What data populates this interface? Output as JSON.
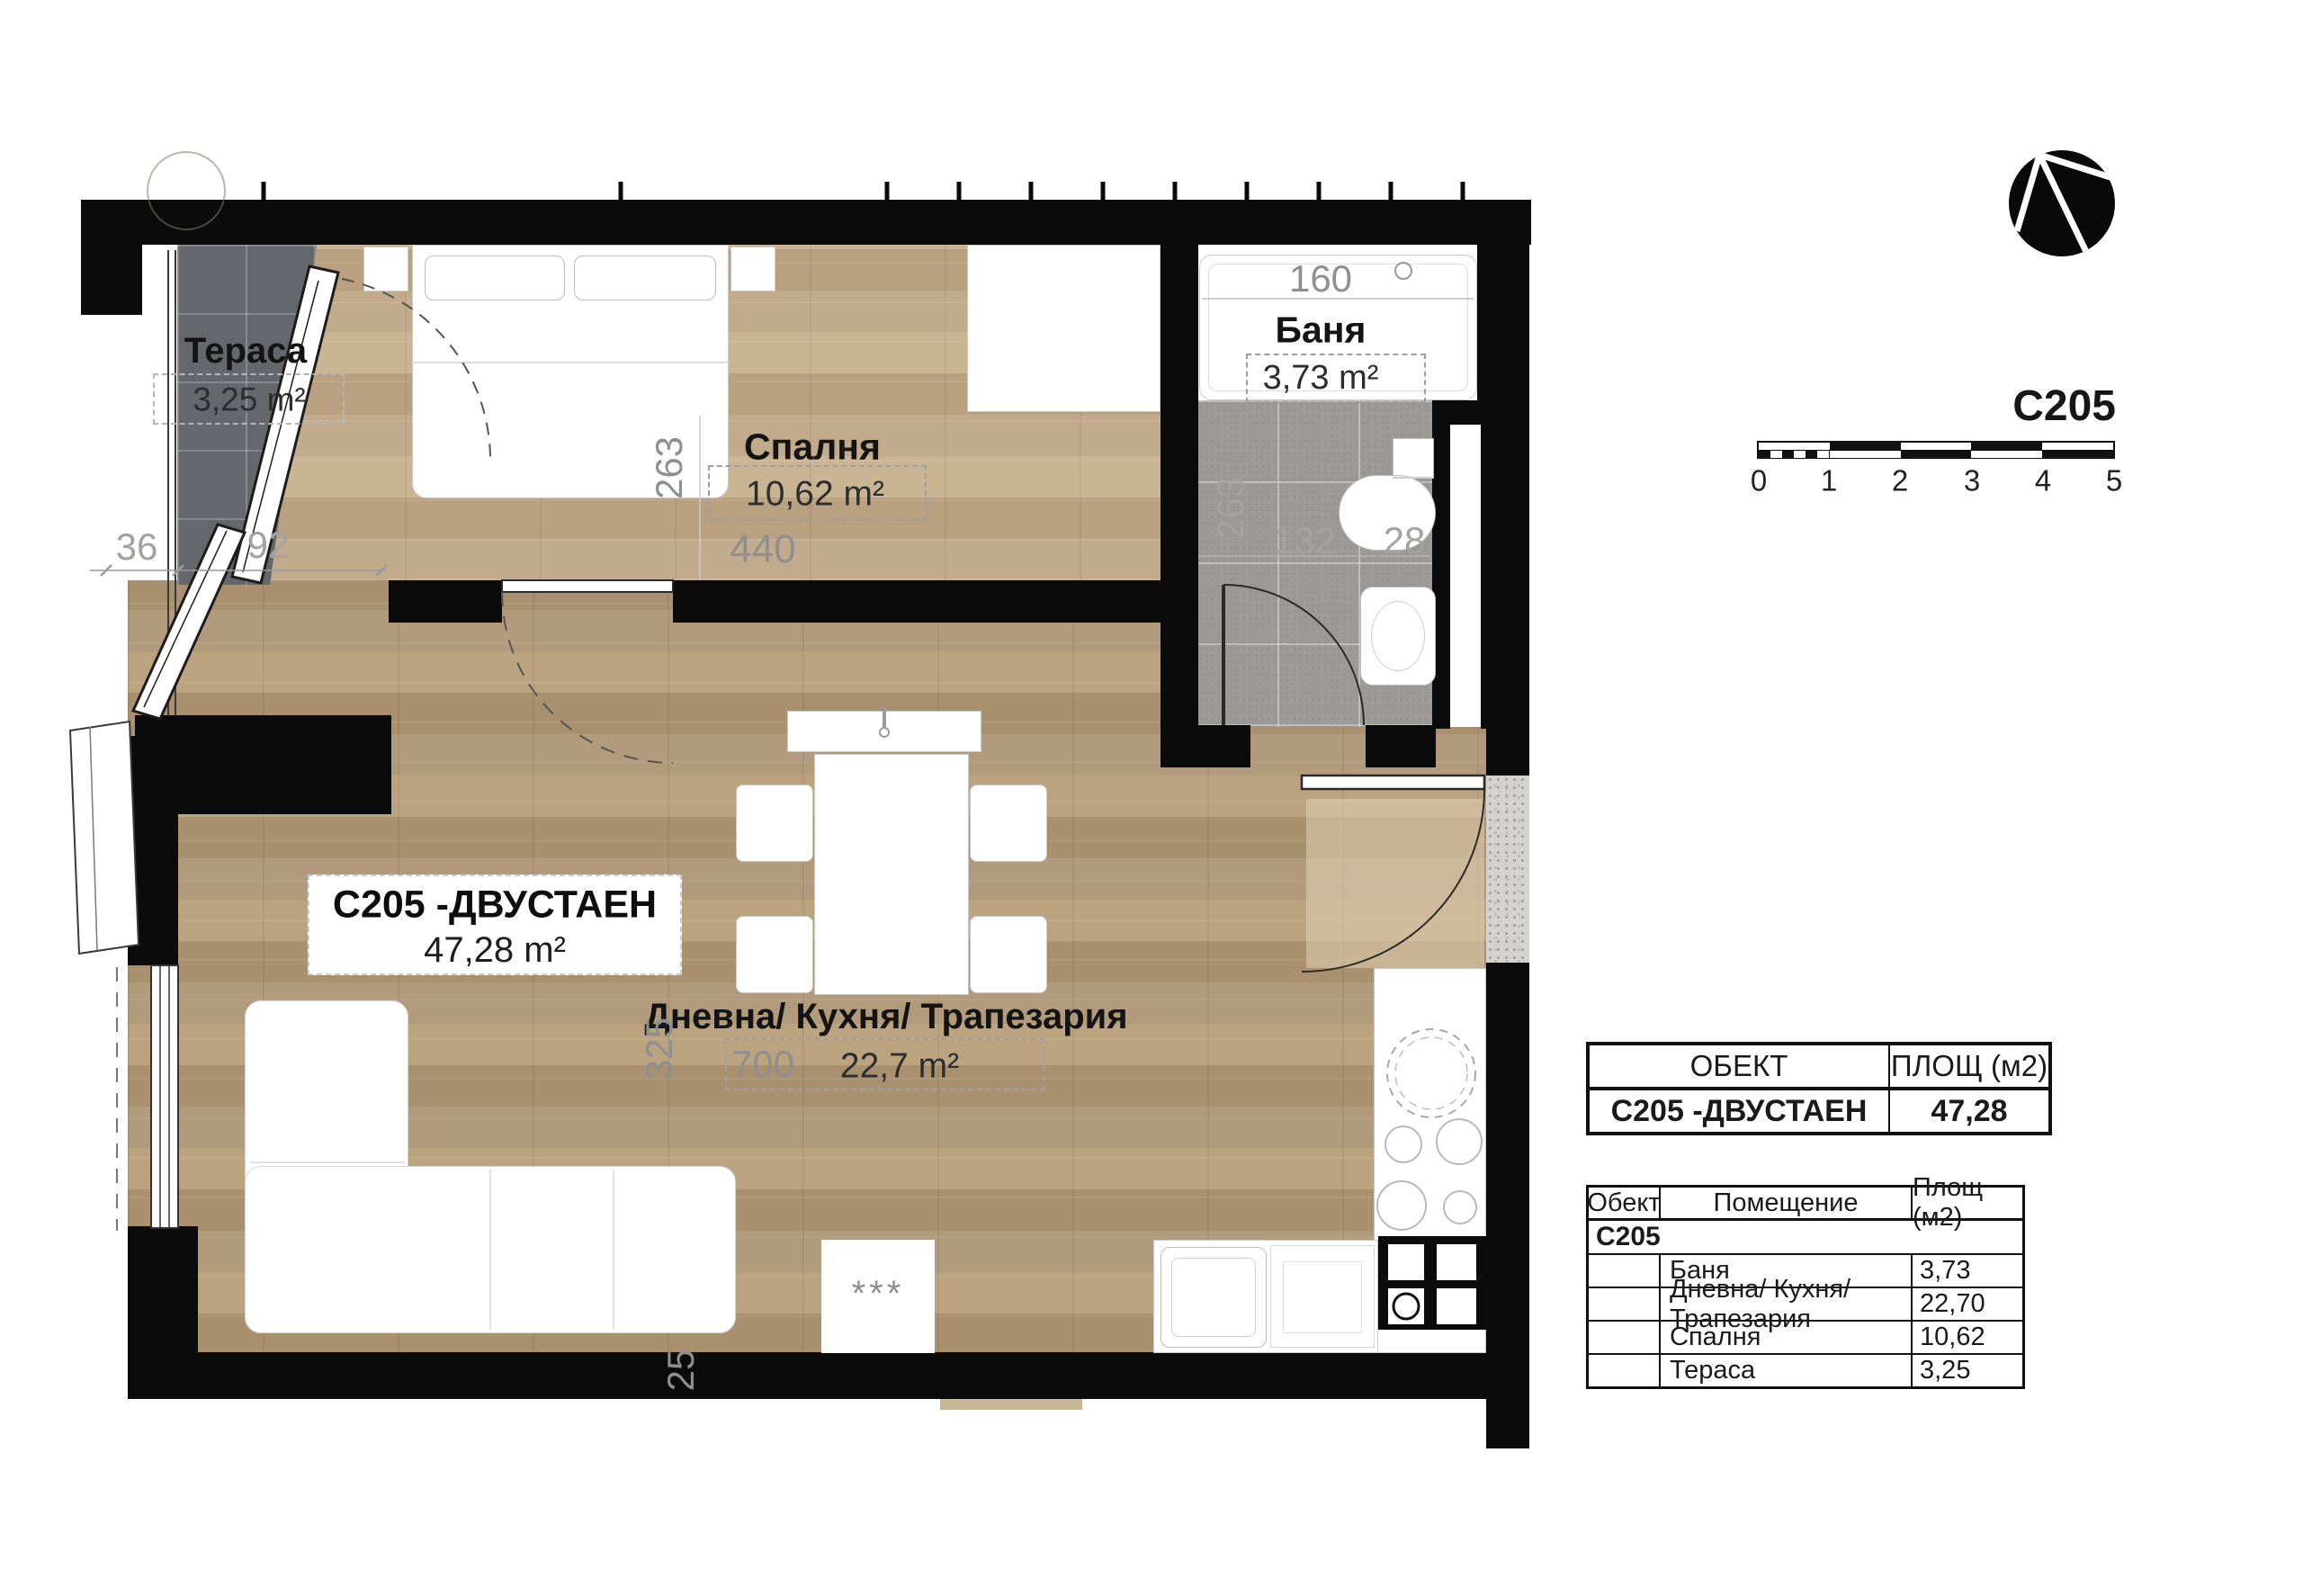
{
  "colors": {
    "wall": "#0b0b0b",
    "wood_living": "#b3997a",
    "wood_bedroom": "#c2ab8c",
    "tile_terrace": "#64686d",
    "tile_bath": "#9c9a96",
    "dim_text": "#8f8f8f"
  },
  "plan": {
    "apartment": {
      "name": "C205 -ДВУСТАЕН",
      "area": "47,28 m²"
    },
    "rooms": {
      "terrace": {
        "name": "Тераса",
        "area": "3,25 m²"
      },
      "bedroom": {
        "name": "Спалня",
        "area": "10,62 m²"
      },
      "bathroom": {
        "name": "Баня",
        "area": "3,73 m²"
      },
      "living": {
        "name": "Дневна/ Кухня/ Трапезария",
        "area": "22,7 m²"
      }
    },
    "dimensions": {
      "terrace_ledge": "36",
      "terrace_width": "92",
      "bedroom_depth": "263",
      "bedroom_width": "440",
      "bath_width": "160",
      "bath_depth": "263",
      "bath_inner": "132",
      "bath_niche": "28",
      "living_depth": "325",
      "living_width": "700",
      "wall_bottom": "25"
    },
    "marks": {
      "rug": "***"
    }
  },
  "panel": {
    "unit_code": "C205",
    "scale_ticks": [
      "0",
      "1",
      "2",
      "3",
      "4",
      "5"
    ],
    "summary_table": {
      "col_object": "ОБЕКТ",
      "col_area": "ПЛОЩ (м2)",
      "row_area": "47,28"
    },
    "rooms_table": {
      "col_object": "Обект",
      "col_room": "Помещение",
      "col_area": "Площ (м2)",
      "group": "C205",
      "rows": [
        {
          "room": "Баня",
          "area": "3,73"
        },
        {
          "room": "Дневна/ Кухня/ Трапезария",
          "area": "22,70"
        },
        {
          "room": "Спалня",
          "area": "10,62"
        },
        {
          "room": "Тераса",
          "area": "3,25"
        }
      ]
    }
  }
}
